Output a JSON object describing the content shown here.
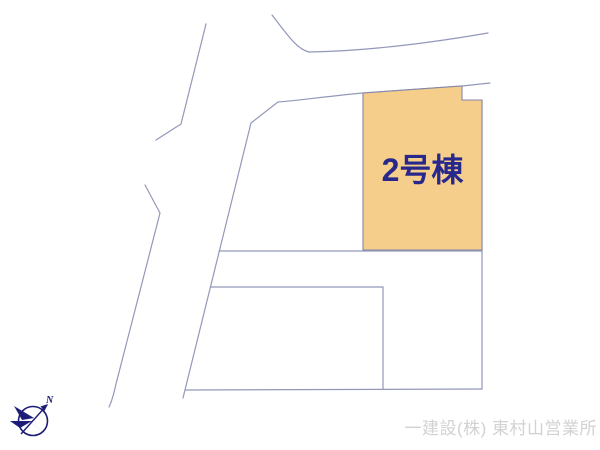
{
  "plan": {
    "parcel": {
      "label": "2号棟",
      "fill": "#f6ce8c",
      "border_color": "#8487a8",
      "label_color": "#28288c"
    },
    "line_color": "#9398ba"
  },
  "compass": {
    "north_label": "N",
    "color": "#1d1d78"
  },
  "footer": {
    "company": "一建設(株) 東村山営業所",
    "color": "#d2d2d2"
  }
}
